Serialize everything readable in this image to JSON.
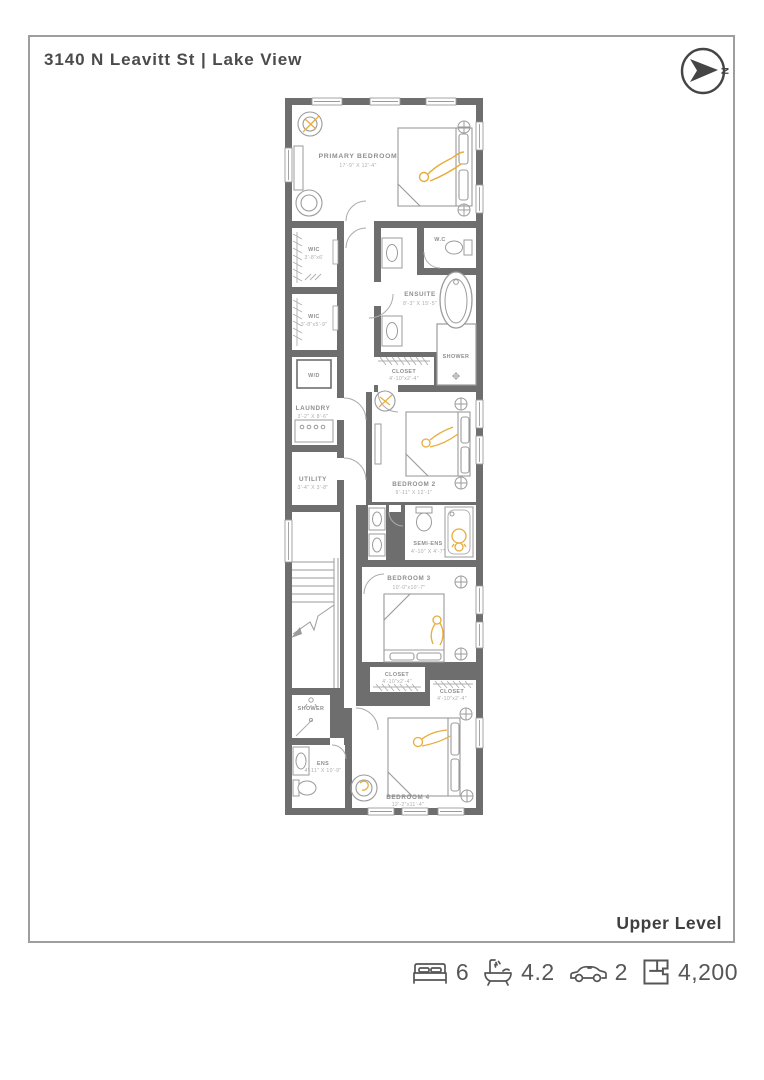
{
  "page": {
    "title": "3140 N Leavitt St | Lake View",
    "level_label": "Upper Level"
  },
  "compass": {
    "north_label": "N"
  },
  "colors": {
    "wall": "#6E6E6E",
    "furniture_line": "#9B9B9B",
    "accent_yellow": "#E8AC3B",
    "room_name_text": "#8E8E8E",
    "room_dims_text": "#ADADAD",
    "title_text": "#4B4B4B",
    "frame_border": "#9E9E9E",
    "stats_text": "#565656"
  },
  "icons": {
    "compass": "compass-north-icon",
    "beds": "bed-icon",
    "baths": "bath-icon",
    "cars": "car-icon",
    "area": "floorplan-icon"
  },
  "rooms": [
    {
      "id": "primary-bedroom",
      "name": "PRIMARY BEDROOM",
      "dims": "17'-9\" X 12'-4\""
    },
    {
      "id": "wic-1",
      "name": "WIC",
      "dims": "3'-8\"x6'"
    },
    {
      "id": "wc",
      "name": "W.C",
      "dims": ""
    },
    {
      "id": "ensuite",
      "name": "ENSUITE",
      "dims": "8'-3\" X 15'-5\""
    },
    {
      "id": "wic-2",
      "name": "WIC",
      "dims": "3'-8\"x5'-9\""
    },
    {
      "id": "washer-dryer",
      "name": "W/D",
      "dims": ""
    },
    {
      "id": "shower-ensuite",
      "name": "SHOWER",
      "dims": ""
    },
    {
      "id": "closet-bedroom2",
      "name": "CLOSET",
      "dims": "4'-10\"x2'-4\""
    },
    {
      "id": "laundry",
      "name": "LAUNDRY",
      "dims": "3'-2\" X 8'-6\""
    },
    {
      "id": "utility",
      "name": "UTILITY",
      "dims": "3'-4\" X 3'-8\""
    },
    {
      "id": "bedroom-2",
      "name": "BEDROOM 2",
      "dims": "9'-11\" X 12'-1\""
    },
    {
      "id": "semi-ens",
      "name": "SEMI-ENS",
      "dims": "4'-10\" X 4'-7\""
    },
    {
      "id": "bedroom-3",
      "name": "BEDROOM 3",
      "dims": "10'-0\"x10'-7\""
    },
    {
      "id": "closet-bedroom3",
      "name": "CLOSET",
      "dims": "4'-10\"x2'-4\""
    },
    {
      "id": "closet-bedroom4",
      "name": "CLOSET",
      "dims": "4'-10\"x2'-4\""
    },
    {
      "id": "shower-lower",
      "name": "SHOWER",
      "dims": ""
    },
    {
      "id": "ens",
      "name": "ENS",
      "dims": "4'-11\" X 10'-9\""
    },
    {
      "id": "bedroom-4",
      "name": "BEDROOM 4",
      "dims": "12'-2\"x11'-4\""
    }
  ],
  "stats": {
    "beds": "6",
    "baths": "4.2",
    "cars": "2",
    "area": "4,200"
  }
}
